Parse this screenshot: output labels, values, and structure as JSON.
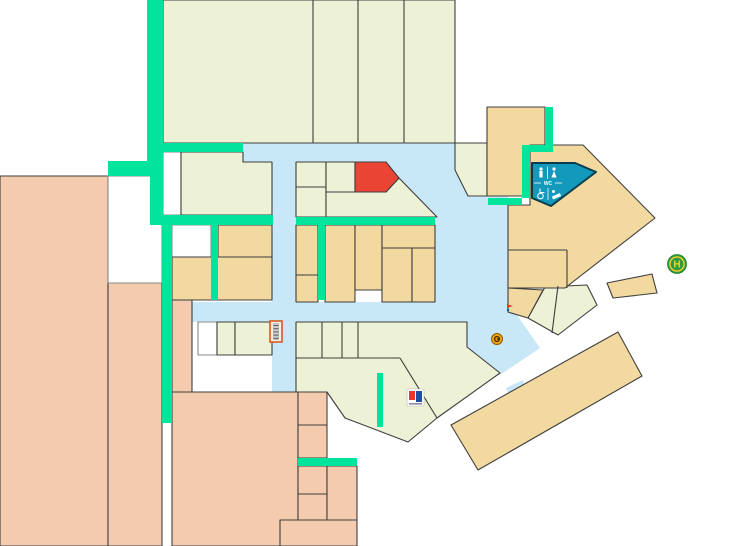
{
  "map": {
    "title": "mall-floor-plan",
    "palette": {
      "cream": "#EDF1D5",
      "tan": "#F1D9A0",
      "salmon": "#F5CBAF",
      "blue": "#C8E8F7",
      "green": "#00E49B",
      "red": "#E94434",
      "teal": "#1399BB",
      "white": "#FFFFFF",
      "outline": "#3F3F3F",
      "outline_light": "#8A8A8A",
      "teal_border": "#0B3C4D",
      "stairs_border": "#D85A1F",
      "busstop_green": "#2E9C3C",
      "busstop_yellow": "#F2D22E",
      "logo_red": "#E8362C",
      "logo_blue": "#1D4FA1",
      "info_orange": "#F4A50C"
    },
    "regions": [
      {
        "name": "walkway-upper",
        "fill": "blue",
        "stroke": "none",
        "interactable": false,
        "rect": [
          243,
          143,
          194,
          19
        ]
      },
      {
        "name": "walkway-plaza",
        "fill": "blue",
        "stroke": "none",
        "interactable": false,
        "points": [
          [
            437,
            143
          ],
          [
            455,
            143
          ],
          [
            455,
            170
          ],
          [
            468,
            196
          ],
          [
            508,
            196
          ],
          [
            508,
            302
          ],
          [
            435,
            302
          ],
          [
            435,
            217
          ],
          [
            399,
            178
          ],
          [
            386,
            162
          ],
          [
            437,
            162
          ]
        ]
      },
      {
        "name": "walkway-vertical",
        "fill": "blue",
        "stroke": "none",
        "interactable": false,
        "rect": [
          272,
          160,
          24,
          232
        ]
      },
      {
        "name": "walkway-lower",
        "fill": "blue",
        "stroke": "none",
        "interactable": false,
        "rect": [
          192,
          302,
          316,
          20
        ]
      },
      {
        "name": "walkway-angled",
        "fill": "blue",
        "stroke": "none",
        "interactable": false,
        "points": [
          [
            455,
            302
          ],
          [
            508,
            302
          ],
          [
            540,
            348
          ],
          [
            500,
            375
          ],
          [
            467,
            347
          ],
          [
            467,
            322
          ],
          [
            455,
            322
          ]
        ]
      },
      {
        "name": "walkway-stub-south",
        "fill": "blue",
        "stroke": "none",
        "interactable": false,
        "points": [
          [
            506,
            388
          ],
          [
            523,
            380
          ],
          [
            532,
            404
          ],
          [
            515,
            412
          ]
        ]
      },
      {
        "name": "anchor-store-west",
        "fill": "salmon",
        "interactable": true,
        "rect": [
          0,
          176,
          108,
          370
        ]
      },
      {
        "name": "anchor-store-west-2",
        "fill": "salmon",
        "interactable": true,
        "rect": [
          108,
          283,
          54,
          263
        ]
      },
      {
        "name": "salmon-strip",
        "fill": "salmon",
        "interactable": true,
        "rect": [
          172,
          283,
          20,
          109
        ]
      },
      {
        "name": "anchor-store-south",
        "fill": "salmon",
        "interactable": true,
        "rect": [
          172,
          392,
          126,
          154
        ]
      },
      {
        "name": "salmon-room-1",
        "fill": "salmon",
        "interactable": true,
        "rect": [
          298,
          392,
          29,
          33
        ]
      },
      {
        "name": "salmon-room-2",
        "fill": "salmon",
        "interactable": true,
        "rect": [
          298,
          425,
          29,
          33
        ]
      },
      {
        "name": "salmon-room-3",
        "fill": "salmon",
        "interactable": true,
        "rect": [
          298,
          466,
          29,
          28
        ]
      },
      {
        "name": "salmon-room-4",
        "fill": "salmon",
        "interactable": true,
        "rect": [
          298,
          494,
          29,
          26
        ]
      },
      {
        "name": "salmon-room-5",
        "fill": "salmon",
        "interactable": true,
        "rect": [
          280,
          520,
          77,
          26
        ]
      },
      {
        "name": "salmon-room-6",
        "fill": "salmon",
        "interactable": true,
        "rect": [
          327,
          466,
          30,
          54
        ]
      },
      {
        "name": "vacant-room-large",
        "fill": "white",
        "stroke": "light",
        "interactable": false,
        "rect": [
          108,
          176,
          54,
          107
        ]
      },
      {
        "name": "vacant-room-1",
        "fill": "white",
        "stroke": "light",
        "interactable": false,
        "rect": [
          163,
          152,
          18,
          63
        ]
      },
      {
        "name": "vacant-room-2",
        "fill": "white",
        "stroke": "light",
        "interactable": false,
        "rect": [
          172,
          225,
          39,
          32
        ]
      },
      {
        "name": "vacant-room-3",
        "fill": "white",
        "stroke": "light",
        "interactable": false,
        "rect": [
          198,
          322,
          19,
          33
        ]
      },
      {
        "name": "anchor-store-north",
        "fill": "cream",
        "interactable": true,
        "rect": [
          163,
          0,
          292,
          143
        ]
      },
      {
        "name": "shop-north-pentagon",
        "fill": "cream",
        "interactable": true,
        "points": [
          [
            455,
            143
          ],
          [
            487,
            143
          ],
          [
            487,
            196
          ],
          [
            468,
            196
          ],
          [
            455,
            170
          ]
        ]
      },
      {
        "name": "shop-west-row",
        "fill": "cream",
        "interactable": true,
        "points": [
          [
            181,
            152
          ],
          [
            243,
            152
          ],
          [
            243,
            162
          ],
          [
            272,
            162
          ],
          [
            272,
            215
          ],
          [
            181,
            215
          ]
        ]
      },
      {
        "name": "shop-b1",
        "fill": "cream",
        "interactable": true,
        "rect": [
          296,
          162,
          30,
          25
        ]
      },
      {
        "name": "shop-b2",
        "fill": "cream",
        "interactable": true,
        "rect": [
          296,
          187,
          30,
          30
        ]
      },
      {
        "name": "shop-b3",
        "fill": "cream",
        "interactable": true,
        "rect": [
          326,
          162,
          29,
          30
        ]
      },
      {
        "name": "shop-below-red",
        "fill": "cream",
        "interactable": true,
        "points": [
          [
            326,
            192
          ],
          [
            386,
            192
          ],
          [
            399,
            178
          ],
          [
            437,
            217
          ],
          [
            326,
            217
          ]
        ]
      },
      {
        "name": "shop-c1",
        "fill": "cream",
        "interactable": true,
        "rect": [
          217,
          322,
          18,
          33
        ]
      },
      {
        "name": "shop-c2",
        "fill": "cream",
        "interactable": true,
        "rect": [
          235,
          322,
          37,
          33
        ]
      },
      {
        "name": "shops-bottom-center",
        "fill": "cream",
        "interactable": true,
        "points": [
          [
            296,
            322
          ],
          [
            455,
            322
          ],
          [
            467,
            322
          ],
          [
            467,
            347
          ],
          [
            500,
            373
          ],
          [
            437,
            418
          ],
          [
            408,
            442
          ],
          [
            345,
            418
          ],
          [
            327,
            392
          ],
          [
            296,
            392
          ]
        ]
      },
      {
        "name": "shops-angled-east",
        "fill": "cream",
        "interactable": true,
        "points": [
          [
            528,
            318
          ],
          [
            545,
            287
          ],
          [
            587,
            285
          ],
          [
            597,
            305
          ],
          [
            558,
            335
          ]
        ]
      },
      {
        "name": "shop-d1",
        "fill": "tan",
        "interactable": true,
        "rect": [
          218,
          225,
          54,
          32
        ]
      },
      {
        "name": "shop-d2",
        "fill": "tan",
        "interactable": true,
        "rect": [
          172,
          257,
          100,
          43
        ]
      },
      {
        "name": "shop-e1",
        "fill": "tan",
        "interactable": true,
        "rect": [
          296,
          225,
          22,
          50
        ]
      },
      {
        "name": "shop-e2",
        "fill": "tan",
        "interactable": true,
        "rect": [
          296,
          275,
          22,
          27
        ]
      },
      {
        "name": "shop-e3",
        "fill": "tan",
        "interactable": true,
        "rect": [
          325,
          225,
          30,
          77
        ]
      },
      {
        "name": "shop-e4",
        "fill": "tan",
        "interactable": true,
        "rect": [
          355,
          225,
          27,
          65
        ]
      },
      {
        "name": "shop-e5",
        "fill": "tan",
        "interactable": true,
        "rect": [
          382,
          225,
          53,
          23
        ]
      },
      {
        "name": "shop-e6",
        "fill": "tan",
        "interactable": true,
        "rect": [
          382,
          248,
          30,
          54
        ]
      },
      {
        "name": "shop-e7",
        "fill": "tan",
        "interactable": true,
        "rect": [
          412,
          248,
          23,
          54
        ]
      },
      {
        "name": "shop-northeast",
        "fill": "tan",
        "interactable": true,
        "rect": [
          487,
          107,
          58,
          89
        ]
      },
      {
        "name": "complex-east",
        "fill": "tan",
        "interactable": true,
        "points": [
          [
            530,
            145
          ],
          [
            583,
            145
          ],
          [
            655,
            218
          ],
          [
            565,
            288
          ],
          [
            508,
            288
          ],
          [
            508,
            205
          ],
          [
            530,
            205
          ]
        ]
      },
      {
        "name": "shop-east-wedge",
        "fill": "tan",
        "interactable": true,
        "points": [
          [
            508,
            288
          ],
          [
            543,
            290
          ],
          [
            528,
            318
          ],
          [
            508,
            312
          ]
        ]
      },
      {
        "name": "shop-east-sliver",
        "fill": "tan",
        "interactable": true,
        "points": [
          [
            607,
            283
          ],
          [
            652,
            274
          ],
          [
            657,
            293
          ],
          [
            613,
            298
          ]
        ]
      },
      {
        "name": "building-southeast",
        "fill": "tan",
        "interactable": true,
        "points": [
          [
            451,
            425
          ],
          [
            618,
            332
          ],
          [
            642,
            376
          ],
          [
            478,
            470
          ]
        ]
      },
      {
        "name": "highlighted-store",
        "fill": "red",
        "interactable": true,
        "points": [
          [
            355,
            162
          ],
          [
            386,
            162
          ],
          [
            399,
            178
          ],
          [
            386,
            192
          ],
          [
            355,
            192
          ]
        ]
      },
      {
        "name": "corridor-north-vertical",
        "fill": "green",
        "stroke": "none",
        "interactable": false,
        "rect": [
          147,
          0,
          16,
          176
        ]
      },
      {
        "name": "corridor-west-arm",
        "fill": "green",
        "stroke": "none",
        "interactable": false,
        "rect": [
          108,
          161,
          55,
          15
        ]
      },
      {
        "name": "corridor-top-bar",
        "fill": "green",
        "stroke": "none",
        "interactable": false,
        "rect": [
          147,
          143,
          96,
          9
        ]
      },
      {
        "name": "corridor-left-vertical",
        "fill": "green",
        "stroke": "none",
        "interactable": false,
        "rect": [
          150,
          152,
          13,
          73
        ]
      },
      {
        "name": "corridor-mid-bar-west",
        "fill": "green",
        "stroke": "none",
        "interactable": false,
        "rect": [
          152,
          215,
          121,
          10
        ]
      },
      {
        "name": "corridor-south-vertical",
        "fill": "green",
        "stroke": "none",
        "interactable": false,
        "rect": [
          162,
          225,
          10,
          198
        ]
      },
      {
        "name": "corridor-divider-west",
        "fill": "green",
        "stroke": "none",
        "interactable": false,
        "rect": [
          211,
          225,
          7,
          75
        ]
      },
      {
        "name": "corridor-mid-bar-center",
        "fill": "green",
        "stroke": "none",
        "interactable": false,
        "rect": [
          296,
          217,
          139,
          8
        ]
      },
      {
        "name": "corridor-center-vertical",
        "fill": "green",
        "stroke": "none",
        "interactable": false,
        "rect": [
          318,
          225,
          7,
          75
        ]
      },
      {
        "name": "corridor-east-vertical",
        "fill": "green",
        "stroke": "none",
        "interactable": false,
        "rect": [
          545,
          107,
          8,
          45
        ]
      },
      {
        "name": "corridor-east-jog",
        "fill": "green",
        "stroke": "none",
        "interactable": false,
        "rect": [
          522,
          145,
          31,
          7
        ]
      },
      {
        "name": "corridor-east-vertical-2",
        "fill": "green",
        "stroke": "none",
        "interactable": false,
        "rect": [
          522,
          152,
          8,
          46
        ]
      },
      {
        "name": "corridor-wc-bar",
        "fill": "green",
        "stroke": "none",
        "interactable": false,
        "rect": [
          488,
          198,
          34,
          7
        ]
      },
      {
        "name": "corridor-bottom-bar",
        "fill": "green",
        "stroke": "none",
        "interactable": false,
        "rect": [
          298,
          458,
          59,
          8
        ]
      },
      {
        "name": "corridor-angled-strip",
        "fill": "green",
        "stroke": "none",
        "interactable": false,
        "rect": [
          377,
          373,
          6,
          54
        ]
      },
      {
        "name": "restrooms",
        "fill": "teal",
        "stroke": "teal",
        "sw": 2,
        "interactable": true,
        "points": [
          [
            532,
            163
          ],
          [
            575,
            163
          ],
          [
            596,
            172
          ],
          [
            551,
            206
          ],
          [
            532,
            198
          ]
        ]
      }
    ],
    "lines": [
      {
        "name": "divider-north-1",
        "x1": 313,
        "y1": 0,
        "x2": 313,
        "y2": 143
      },
      {
        "name": "divider-north-2",
        "x1": 358,
        "y1": 0,
        "x2": 358,
        "y2": 143
      },
      {
        "name": "divider-north-3",
        "x1": 404,
        "y1": 0,
        "x2": 404,
        "y2": 143
      },
      {
        "name": "divider-east-1",
        "x1": 508,
        "y1": 250,
        "x2": 567,
        "y2": 250
      },
      {
        "name": "divider-east-2",
        "x1": 567,
        "y1": 250,
        "x2": 567,
        "y2": 288
      },
      {
        "name": "divider-bc-1",
        "x1": 322,
        "y1": 322,
        "x2": 322,
        "y2": 358
      },
      {
        "name": "divider-bc-2",
        "x1": 342,
        "y1": 322,
        "x2": 342,
        "y2": 358
      },
      {
        "name": "divider-bc-3",
        "x1": 358,
        "y1": 322,
        "x2": 358,
        "y2": 358
      },
      {
        "name": "divider-bc-4",
        "x1": 296,
        "y1": 358,
        "x2": 400,
        "y2": 358
      },
      {
        "name": "divider-bc-5",
        "x1": 400,
        "y1": 358,
        "x2": 437,
        "y2": 418
      },
      {
        "name": "divider-angled-east",
        "x1": 558,
        "y1": 286,
        "x2": 552,
        "y2": 333
      }
    ],
    "icons": {
      "wc": {
        "label": "WC",
        "x": 532,
        "y": 163
      },
      "stairs": {
        "x": 270,
        "y": 321,
        "w": 12,
        "h": 21
      },
      "store_logo": {
        "x": 407,
        "y": 389,
        "w": 17,
        "h": 17
      },
      "info_point": {
        "cx": 497,
        "cy": 339,
        "r": 5.5
      },
      "marker": {
        "x": 507,
        "y": 304
      },
      "busstop": {
        "label": "H",
        "cx": 677,
        "cy": 264,
        "r": 9.5
      }
    }
  }
}
